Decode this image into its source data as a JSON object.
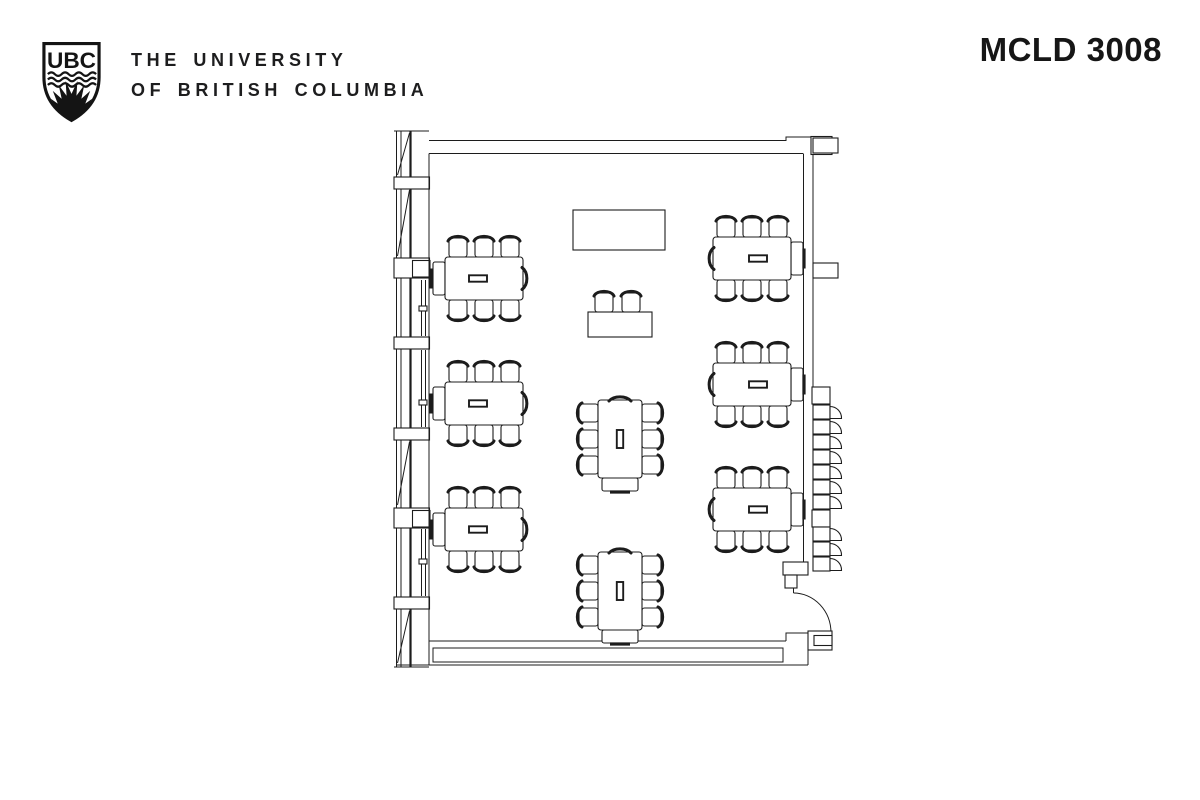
{
  "header": {
    "logo_monogram": "UBC",
    "university_line1": "THE UNIVERSITY",
    "university_line2": "OF BRITISH COLUMBIA",
    "room_title": "MCLD 3008"
  },
  "colors": {
    "line": "#1c1c1c",
    "text": "#1d1d1e",
    "background": "#ffffff"
  },
  "floor_plan": {
    "description": "Classroom floor plan with eight 6-seat tables, one 2-seat table, a lectern, window wall on the left, entry door at bottom right and fold-down wall seats outside the right wall",
    "metrics": {
      "table_body": 78,
      "table_ext": 12,
      "table_across": 43,
      "chair_offsets": [
        13,
        39,
        65
      ]
    },
    "tables": [
      {
        "id": "left-1",
        "orient": "h",
        "x": 433,
        "y": 257,
        "ext": "start",
        "arc": "end",
        "bar": "start"
      },
      {
        "id": "left-2",
        "orient": "h",
        "x": 433,
        "y": 382,
        "ext": "start",
        "arc": "end",
        "bar": "start"
      },
      {
        "id": "left-3",
        "orient": "h",
        "x": 433,
        "y": 508,
        "ext": "start",
        "arc": "end",
        "bar": "start"
      },
      {
        "id": "right-1",
        "orient": "h",
        "x": 713,
        "y": 237,
        "ext": "end",
        "arc": "start",
        "bar": "end"
      },
      {
        "id": "right-2",
        "orient": "h",
        "x": 713,
        "y": 363,
        "ext": "end",
        "arc": "start",
        "bar": "end"
      },
      {
        "id": "right-3",
        "orient": "h",
        "x": 713,
        "y": 488,
        "ext": "end",
        "arc": "start",
        "bar": "end"
      },
      {
        "id": "center-1",
        "orient": "v",
        "x": 598,
        "y": 400,
        "ext": "end",
        "arc": "start",
        "bar": null
      },
      {
        "id": "center-2",
        "orient": "v",
        "x": 598,
        "y": 552,
        "ext": "end",
        "arc": "start",
        "bar": null
      }
    ],
    "chairs_per_table": 6,
    "duo_table": {
      "x": 588,
      "y": 312,
      "w": 64,
      "h": 25,
      "chair_centers": [
        604,
        631
      ]
    },
    "lectern": {
      "x": 573,
      "y": 210,
      "w": 92,
      "h": 40
    },
    "wall_seats": {
      "groups": [
        {
          "box_y": 387,
          "first_seat_y": 405,
          "count": 7
        },
        {
          "box_y": 510,
          "first_seat_y": 527,
          "count": 3
        }
      ]
    }
  }
}
